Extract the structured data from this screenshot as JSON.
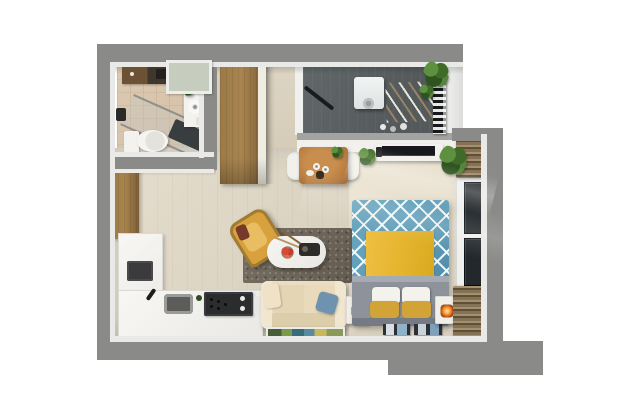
{
  "scene": {
    "title": "studio-apartment-3d-floor-plan",
    "view": "top-down",
    "rooms": [
      {
        "name": "bathroom",
        "items": [
          "storage-shelf",
          "wall-niche",
          "vanity-sink",
          "shower-glass",
          "shower-mat",
          "shower-head",
          "toilet"
        ]
      },
      {
        "name": "entry",
        "items": [
          "entry-cabinet",
          "wardrobe"
        ]
      },
      {
        "name": "kitchen",
        "items": [
          "l-shaped-counter",
          "countertop-appliance",
          "faucet",
          "sink",
          "cooktop",
          "bottle",
          "cutting-board"
        ]
      },
      {
        "name": "living-area",
        "items": [
          "area-rug",
          "armchair",
          "coffee-table",
          "flower-bowl",
          "tray",
          "sofa",
          "throw-pillows",
          "floor-painting",
          "lamp-side-table"
        ]
      },
      {
        "name": "dining-area",
        "items": [
          "dining-table",
          "dining-chair-left",
          "dining-chair-right",
          "cups",
          "teapot",
          "table-plant"
        ]
      },
      {
        "name": "bedroom",
        "items": [
          "double-bed",
          "yellow-throw",
          "pillows",
          "nightstand",
          "magazines",
          "tv-console",
          "tv",
          "window",
          "blinds",
          "potted-plants",
          "carpet"
        ]
      },
      {
        "name": "balcony",
        "items": [
          "washing-machine",
          "drying-rack",
          "mop",
          "detergent-bottles",
          "ladder-rack",
          "balcony-plants"
        ]
      }
    ]
  },
  "palette": {
    "background": "#ffffff",
    "wall": "#8a8b89",
    "wall_edge": "#e9eae7",
    "floor_main": "#dcd4c3",
    "floor_main_deep": "#cdc3ae",
    "floor_bath": "#d4c0a8",
    "floor_balcony": "#54595c",
    "floor_bedroom": "#e6ddcb",
    "wood": "#a9854f",
    "wood_dark": "#7c5f38",
    "counter": "#f4f3ef",
    "appliance": "#313336",
    "sofa": "#e9ddc2",
    "armchair": "#d9a13e",
    "rug": "#6e655a",
    "bed_blue": "#5e9cb8",
    "bed_yellow": "#e5b42e",
    "bed_gray": "#8d929b",
    "pillow_yellow": "#d2a438",
    "pillow_white": "#f4f2ed",
    "lamp_glow": "#ff9433",
    "plant": "#3f6b28",
    "plant_dark": "#2f5420",
    "tv": "#17191c",
    "curtain": "#857254",
    "curtain_light": "#a5906e",
    "glass": "#23282c",
    "flower": "#c93a2e",
    "table_wood": "#b5793f"
  }
}
